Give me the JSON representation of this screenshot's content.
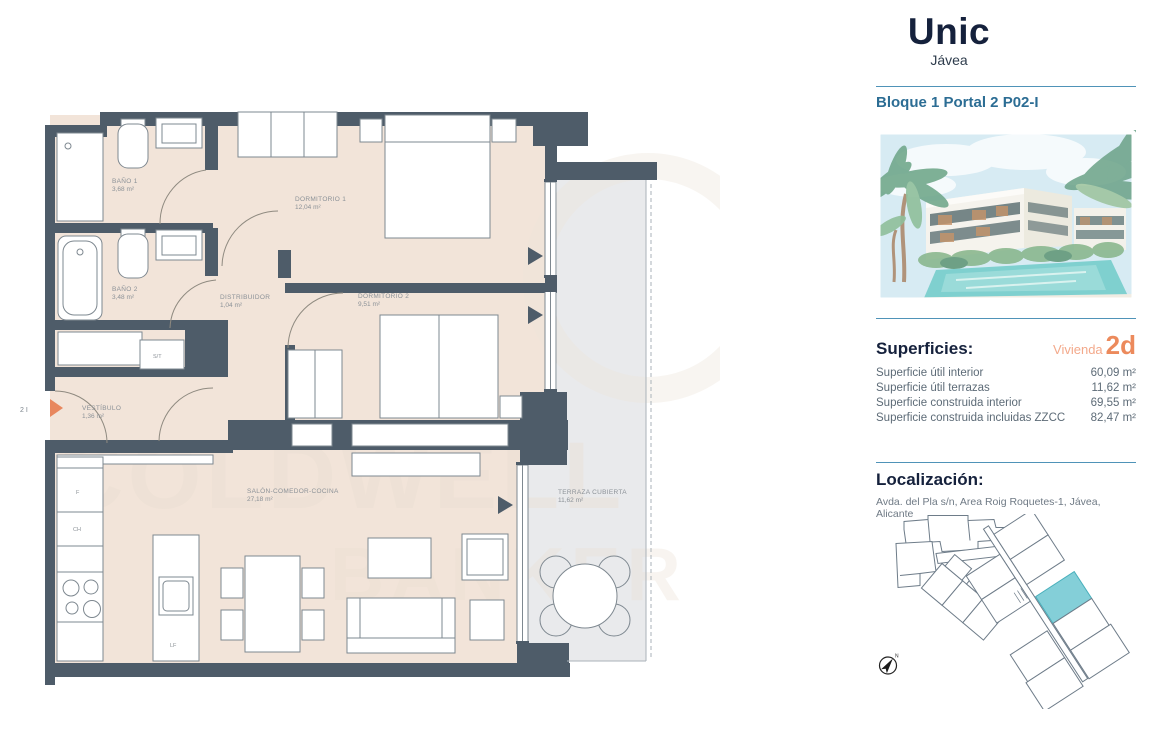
{
  "brand": {
    "name": "Unic",
    "subtitle": "Jávea"
  },
  "header": {
    "block_title": "Bloque 1 Portal 2 P02-I"
  },
  "superficies": {
    "heading": "Superficies:",
    "unit_type_label": "Vivienda",
    "unit_type_value": "2d",
    "rows": [
      {
        "label": "Superficie útil interior",
        "value": "60,09 m²"
      },
      {
        "label": "Superficie útil terrazas",
        "value": "11,62 m²"
      },
      {
        "label": "Superficie construida interior",
        "value": "69,55 m²"
      },
      {
        "label": "Superficie construida incluidas ZZCC",
        "value": "82,47 m²"
      }
    ]
  },
  "localizacion": {
    "heading": "Localización:",
    "address": "Avda. del Pla s/n, Area Roig Roquetes-1, Jávea, Alicante"
  },
  "floorplan": {
    "entry_label": "2 I",
    "watermark_line1": "COLDWELL",
    "watermark_line2": "BANKER",
    "rooms": [
      {
        "name": "BAÑO 1",
        "area": "3,68 m²"
      },
      {
        "name": "DORMITORIO 1",
        "area": "12,04 m²"
      },
      {
        "name": "BAÑO 2",
        "area": "3,48 m²"
      },
      {
        "name": "DISTRIBUIDOR",
        "area": "1,04 m²"
      },
      {
        "name": "DORMITORIO 2",
        "area": "9,51 m²"
      },
      {
        "name": "VESTÍBULO",
        "area": "1,36 m²"
      },
      {
        "name": "SALÓN-COMEDOR-COCINA",
        "area": "27,18 m²"
      },
      {
        "name": "TERRAZA CUBIERTA",
        "area": "11,62 m²"
      }
    ],
    "appliance_labels": {
      "fridge": "F",
      "ch": "CH",
      "laundry": "S/T",
      "dishwasher": "LF"
    }
  },
  "siteplan": {
    "compass_label": "N"
  },
  "colors": {
    "wall": "#4e5c69",
    "floor": "#f2e4d9",
    "terrace": "#e9eaec",
    "accent_orange": "#ec8a5c",
    "brand_navy": "#15213c",
    "heading_blue": "#2c6d94",
    "separator_blue": "#4f93b8",
    "siteplan_highlight": "#84cfd8"
  }
}
